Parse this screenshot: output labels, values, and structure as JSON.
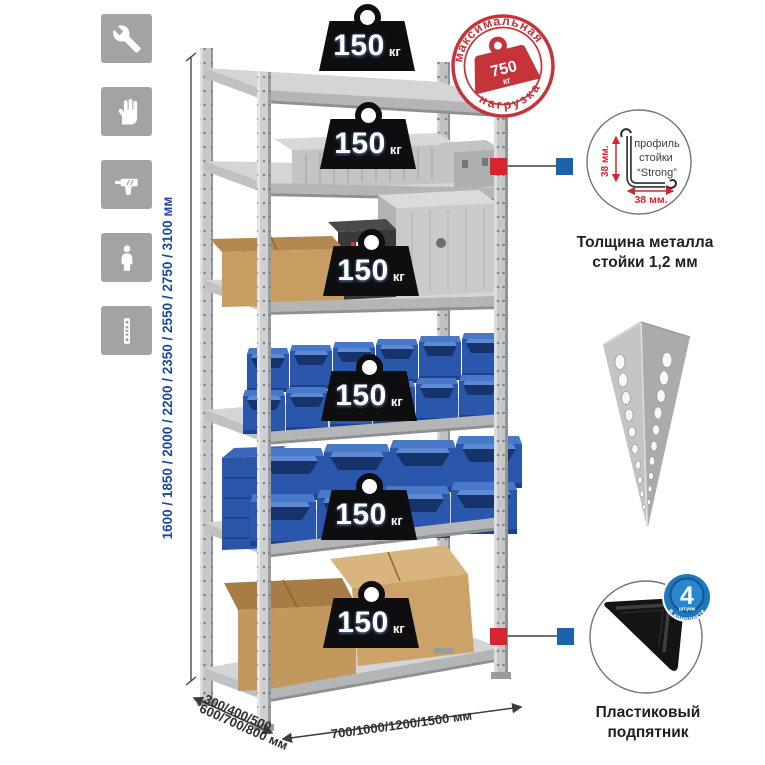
{
  "assembly_icons": {
    "items": [
      {
        "icon": "wrench"
      },
      {
        "icon": "gloves"
      },
      {
        "icon": "drill"
      },
      {
        "icon": "person"
      },
      {
        "icon": "upright-post"
      }
    ]
  },
  "height_dimension": {
    "label": "1600 / 1850 / 2000 / 2200 / 2350 / 2550 / 2750 / 3100 мм"
  },
  "rack": {
    "shelf_load_badge": {
      "value": "150",
      "unit": "кг"
    },
    "shelves_with_badges": 6
  },
  "max_load_stamp": {
    "arc_top": "максимальная",
    "arc_bottom": "нагрузка",
    "value": "750",
    "unit": "кг",
    "color": "#c5333b"
  },
  "profile_detail": {
    "line1": "профиль",
    "line2": "стойки",
    "line3": "“Strong”",
    "height_dim": "38 мм.",
    "width_dim": "38 мм.",
    "caption1": "Толщина металла",
    "caption2": "стойки 1,2 мм"
  },
  "foot_detail": {
    "badge_value": "4",
    "badge_unit": "штуки",
    "badge_arc": "в комплекте",
    "caption1": "Пластиковый",
    "caption2": "подпятник"
  },
  "base_dimensions": {
    "depth_line1": "300/400/500",
    "depth_line2": "600/700/800 мм",
    "width": "700/1000/1200/1500 мм"
  },
  "colors": {
    "stamp_red": "#c5333b",
    "connector_red": "#d8252c",
    "connector_blue": "#1b64ad",
    "bin_blue": "#2a56ab",
    "badge_blue": "#1c77be",
    "dim_text_blue": "#1c4697",
    "metal_light": "#d4d5d7",
    "icon_tile_gray": "#a2a3a5"
  }
}
